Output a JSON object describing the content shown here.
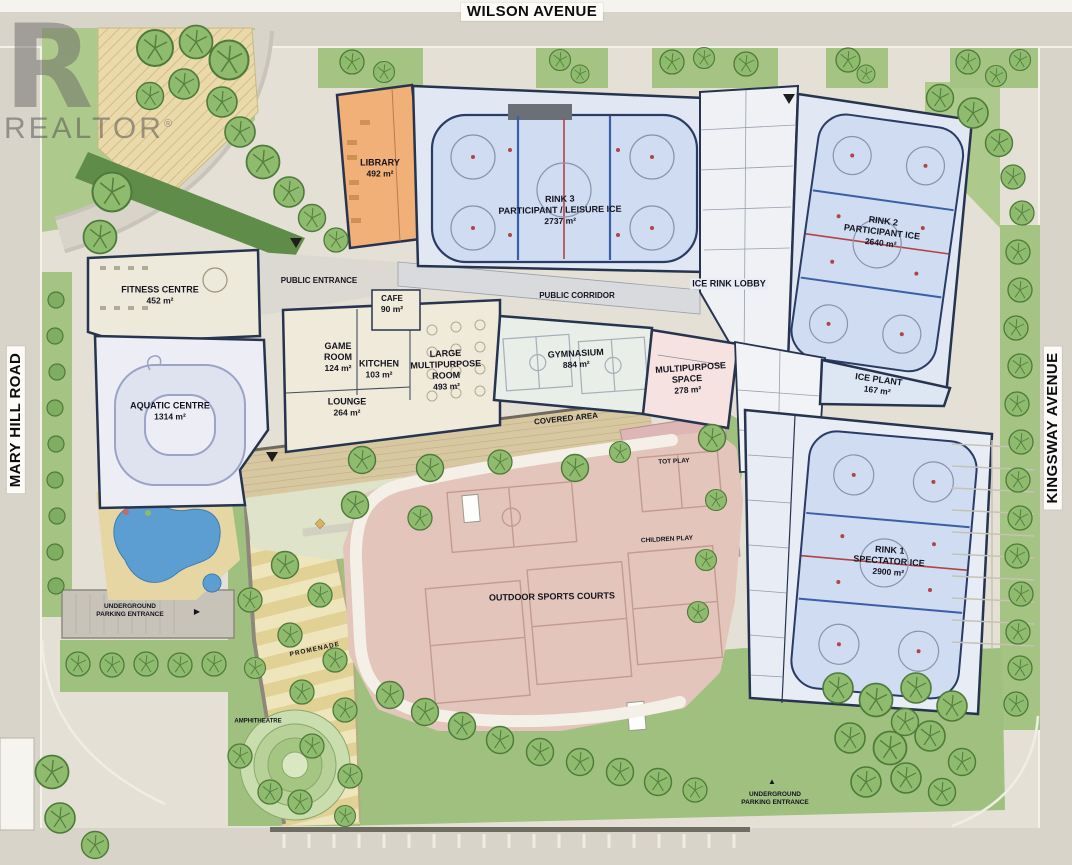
{
  "streets": {
    "top": "WILSON AVENUE",
    "left": "MARY HILL ROAD",
    "right": "KINGSWAY AVENUE"
  },
  "watermark": {
    "logo_letter": "R",
    "text": "REALTOR",
    "registered": "®"
  },
  "rooms": {
    "library": {
      "name": "LIBRARY",
      "area": "492 m²"
    },
    "rink3": {
      "name": "RINK 3",
      "type": "PARTICIPANT / LEISURE ICE",
      "area": "2737 m²"
    },
    "rink2": {
      "name": "RINK 2",
      "type": "PARTICIPANT ICE",
      "area": "2640 m²"
    },
    "rink1": {
      "name": "RINK 1",
      "type": "SPECTATOR ICE",
      "area": "2900 m²"
    },
    "ice_plant": {
      "name": "ICE PLANT",
      "area": "167 m²"
    },
    "ice_rink_lobby": {
      "name": "ICE RINK LOBBY"
    },
    "fitness": {
      "name": "FITNESS CENTRE",
      "area": "452 m²"
    },
    "aquatic": {
      "name": "AQUATIC CENTRE",
      "area": "1314 m²"
    },
    "cafe": {
      "name": "CAFE",
      "area": "90 m²"
    },
    "game_room": {
      "name": "GAME ROOM",
      "area": "124 m²"
    },
    "kitchen": {
      "name": "KITCHEN",
      "area": "103 m²"
    },
    "large_multipurpose": {
      "name": "LARGE MULTIPURPOSE ROOM",
      "area": "493 m²"
    },
    "lounge": {
      "name": "LOUNGE",
      "area": "264 m²"
    },
    "gymnasium": {
      "name": "GYMNASIUM",
      "area": "884 m²"
    },
    "multipurpose_space": {
      "name": "MULTIPURPOSE SPACE",
      "area": "278 m²"
    }
  },
  "labels": {
    "public_entrance": "PUBLIC ENTRANCE",
    "public_corridor": "PUBLIC CORRIDOR",
    "covered_area": "COVERED AREA",
    "tot_play": "TOT PLAY",
    "children_play": "CHILDREN PLAY",
    "outdoor_sports_courts": "OUTDOOR SPORTS COURTS",
    "promenade": "PROMENADE",
    "amphitheatre": "AMPHITHEATRE",
    "underground": "UNDERGROUND",
    "parking_entrance": "PARKING ENTRANCE"
  },
  "icons": {
    "arrow_right": "▶",
    "arrow_up": "▲"
  },
  "colors": {
    "road": "#d8d4ca",
    "site": "#e4e0d5",
    "green": "#9fc07e",
    "hedge": "#5f8c49",
    "ice": "#cfdcf2",
    "ice_building": "#e2e8f3",
    "wall_navy": "#27344f",
    "library_orange": "#f0b077",
    "cream": "#efead9",
    "pink_room": "#f6e3e1",
    "courts_pink": "#e3c5bb",
    "covered_tan": "#d8c8a2",
    "water_blue": "#5d9ed2",
    "promenade_tan": "#e2d194"
  }
}
